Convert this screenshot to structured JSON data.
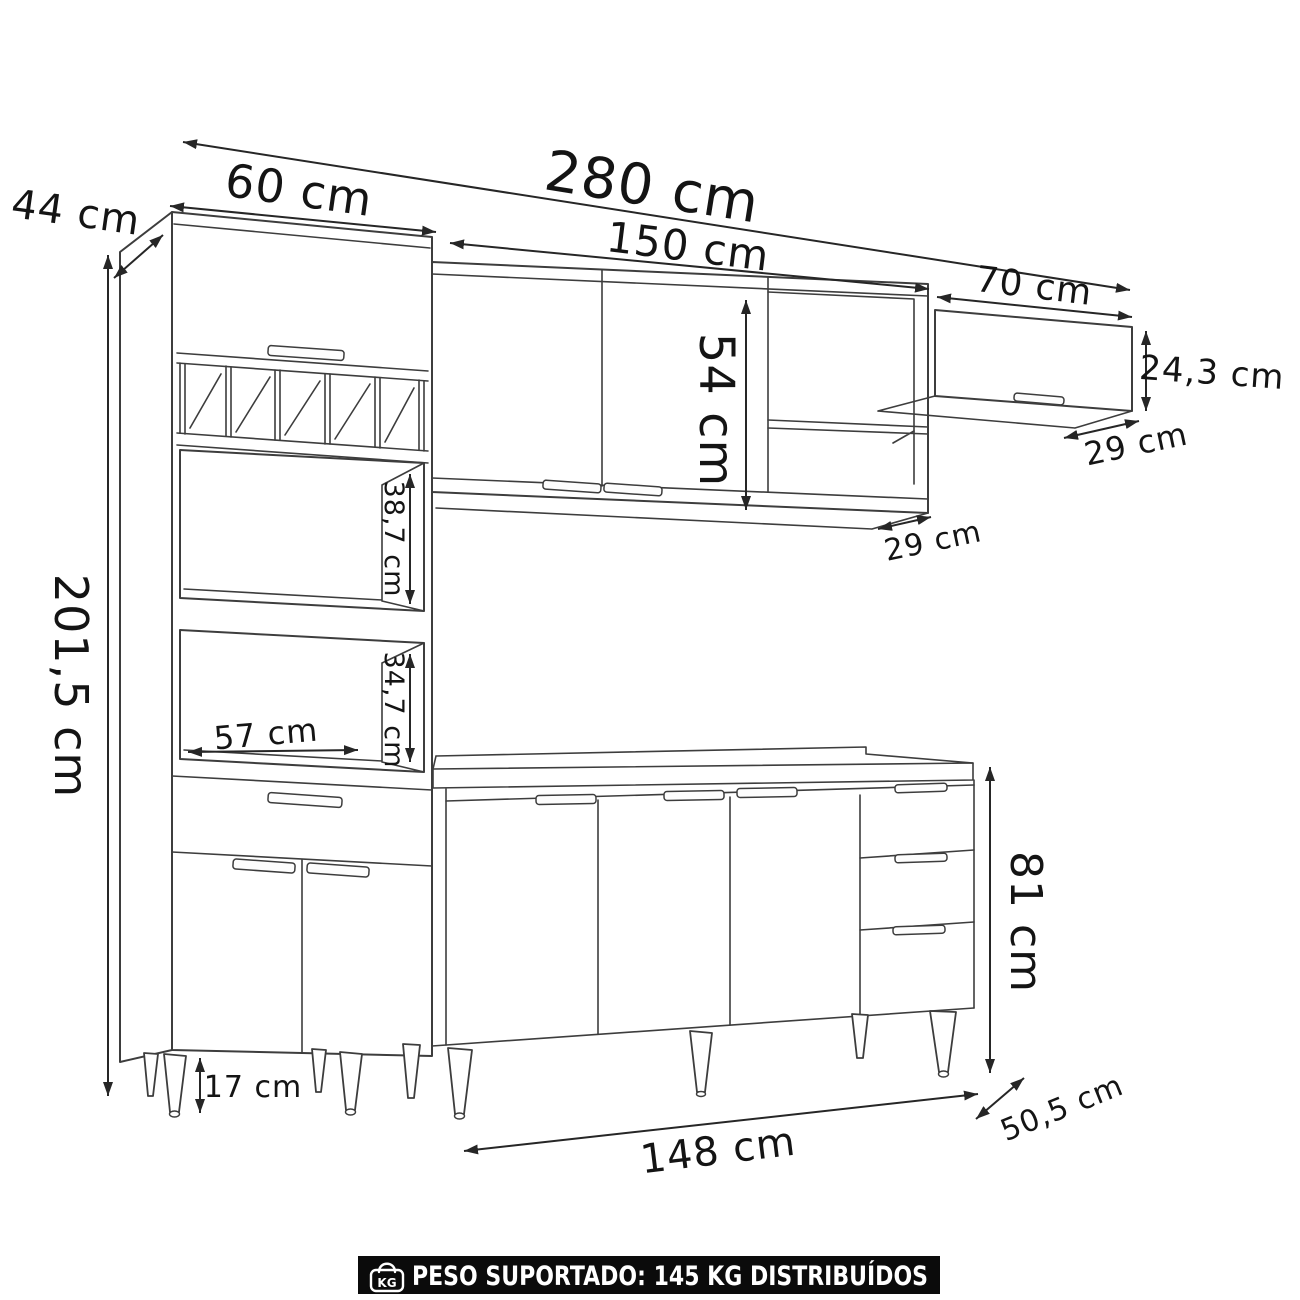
{
  "diagram": {
    "labels": {
      "total_width": "280 cm",
      "hutch_width": "60 cm",
      "hutch_depth": "44 cm",
      "hutch_height": "201,5 cm",
      "wall_cabinet_width": "150 cm",
      "wall_cabinet_inner_height": "54 cm",
      "wall_cabinet_depth": "29 cm",
      "upper_cabinet_width": "70 cm",
      "upper_cabinet_height": "24,3 cm",
      "upper_cabinet_depth": "29 cm",
      "top_niche_height": "38,7 cm",
      "bottom_niche_height": "34,7 cm",
      "niche_width": "57 cm",
      "foot_height": "17 cm",
      "base_cabinet_width": "148 cm",
      "base_cabinet_depth": "50,5 cm",
      "base_cabinet_height": "81 cm"
    },
    "colors": {
      "line": "#3d3d3d",
      "text": "#141414",
      "banner_bg": "#0b0b0b",
      "banner_text": "#ffffff"
    }
  },
  "footer": {
    "icon_label": "KG",
    "text": "PESO SUPORTADO: 145 KG DISTRIBUÍDOS"
  }
}
